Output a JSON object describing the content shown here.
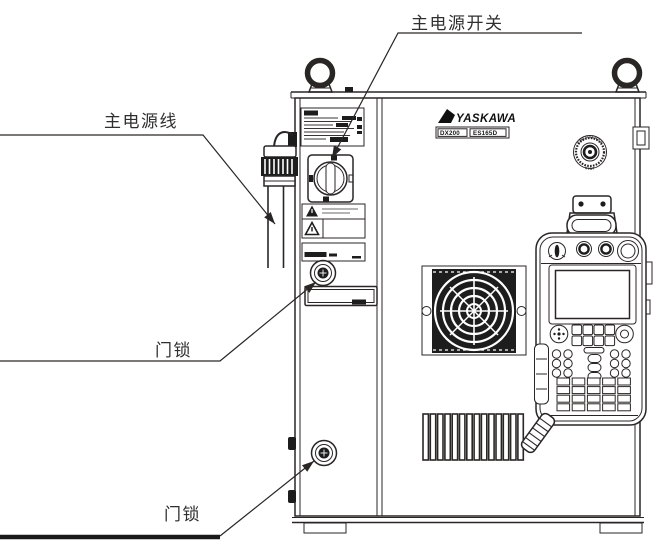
{
  "page": {
    "background": "#ffffff"
  },
  "colors": {
    "line": "#2a2626",
    "dark_fill": "#1d1d1d",
    "label_text": "#2f2f2f"
  },
  "callouts": [
    {
      "id": "main-power-switch",
      "text": "主电源开关"
    },
    {
      "id": "main-power-cable",
      "text": "主电源线"
    },
    {
      "id": "door-lock-upper",
      "text": "门锁"
    },
    {
      "id": "door-lock-lower",
      "text": "门锁"
    }
  ],
  "cabinet": {
    "brand": "YASKAWA",
    "model": "DX200",
    "series": "ES165D",
    "emergency_stop": {
      "top": "EMERGENCY",
      "bottom": "STOP"
    }
  }
}
